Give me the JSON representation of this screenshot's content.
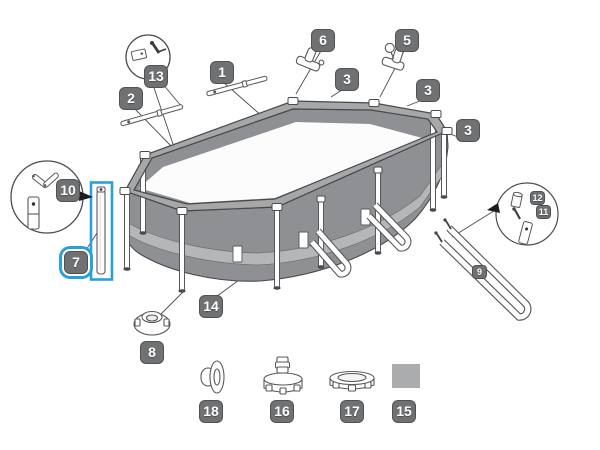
{
  "page": {
    "background": "#ffffff"
  },
  "diagram": {
    "type": "exploded-parts-diagram",
    "subject": "oval-frame-pool",
    "badge_bg": "#6f7173",
    "badge_text_color": "#ffffff",
    "highlight_color": "#2aa0d8",
    "pool_wall_gray": "#8f9093",
    "rail_gray": "#a5a7a9",
    "band_gray": "#b4b6b8",
    "patch_gray": "#aaacae",
    "selected_part": "7",
    "callouts": {
      "c1": {
        "label": "1"
      },
      "c2": {
        "label": "2"
      },
      "c3a": {
        "label": "3"
      },
      "c3b": {
        "label": "3"
      },
      "c3c": {
        "label": "3"
      },
      "c5": {
        "label": "5"
      },
      "c6": {
        "label": "6"
      },
      "c7": {
        "label": "7",
        "highlighted": true
      },
      "c8": {
        "label": "8"
      },
      "c9": {
        "label": "9"
      },
      "c10": {
        "label": "10"
      },
      "c11": {
        "label": "11"
      },
      "c12": {
        "label": "12"
      },
      "c13": {
        "label": "13"
      },
      "c14": {
        "label": "14"
      },
      "c15": {
        "label": "15"
      },
      "c16": {
        "label": "16"
      },
      "c17": {
        "label": "17"
      },
      "c18": {
        "label": "18"
      }
    }
  }
}
